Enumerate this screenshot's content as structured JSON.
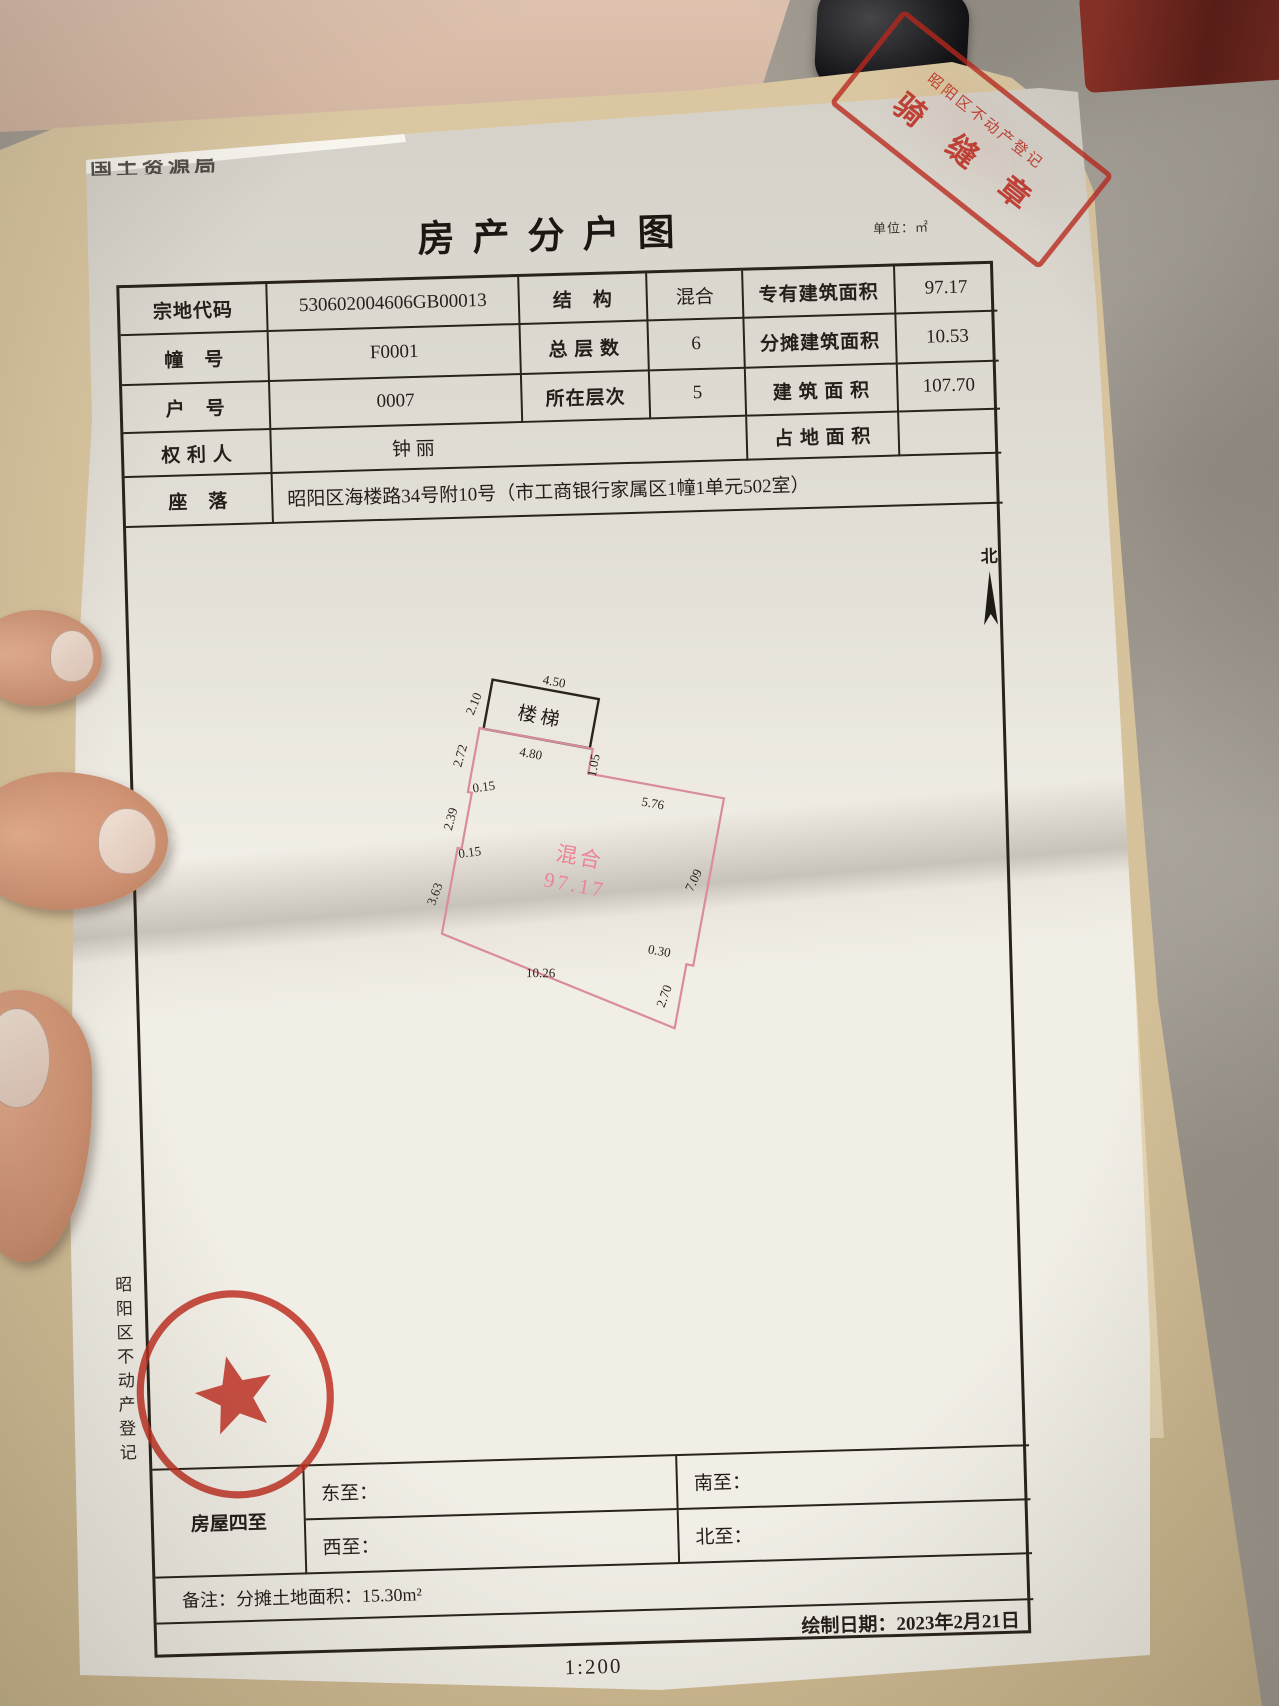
{
  "doc": {
    "corner_fragment": "国土资源局",
    "title": "房产分户图",
    "unit_note": "单位：㎡",
    "info": {
      "r1c1": "宗地代码",
      "r1c2": "530602004606GB00013",
      "r1c3": "结　构",
      "r1c4": "混合",
      "r1c5": "专有建筑面积",
      "r1c6": "97.17",
      "r2c1": "幢　号",
      "r2c2": "F0001",
      "r2c3": "总 层 数",
      "r2c4": "6",
      "r2c5": "分摊建筑面积",
      "r2c6": "10.53",
      "r3c1": "户　号",
      "r3c2": "0007",
      "r3c3": "所在层次",
      "r3c4": "5",
      "r3c5": "建 筑 面 积",
      "r3c6": "107.70",
      "r4c1": "权 利 人",
      "r4c2": "钟 丽",
      "r4c5": "占 地 面 积",
      "r4c6": "",
      "r5c1": "座　落",
      "r5c2": "昭阳区海楼路34号附10号（市工商银行家属区1幢1单元502室）"
    },
    "north_label": "北",
    "plan": {
      "stairs": "楼梯",
      "type_label": "混合",
      "area": "97.17",
      "d_stair_w": "4.50",
      "d_stair_h": "2.10",
      "d_top1": "4.80",
      "d_step": "1.05",
      "d_top2": "5.76",
      "d_right": "7.09",
      "d_notch": "0.30",
      "d_right2": "2.70",
      "d_bottom": "10.26",
      "d_left3": "3.63",
      "d_jog2": "0.15",
      "d_left2": "2.39",
      "d_jog1": "0.15",
      "d_left1": "2.72"
    },
    "boundary": {
      "group": "房屋四至",
      "east": "东至：",
      "south": "南至：",
      "west": "西至：",
      "north": "北至：",
      "remark": "备注：分摊土地面积：15.30m²",
      "date": "绘制日期：2023年2月21日"
    },
    "side_text": "昭阳区不动产登记",
    "scale": "1:200"
  },
  "stamps": {
    "seam": {
      "line1": "昭阳区不动产登记",
      "line2": "骑 缝 章"
    },
    "round": {
      "arc": "昭通市昭阳区不动产登记",
      "digits": "5306002321133"
    }
  }
}
